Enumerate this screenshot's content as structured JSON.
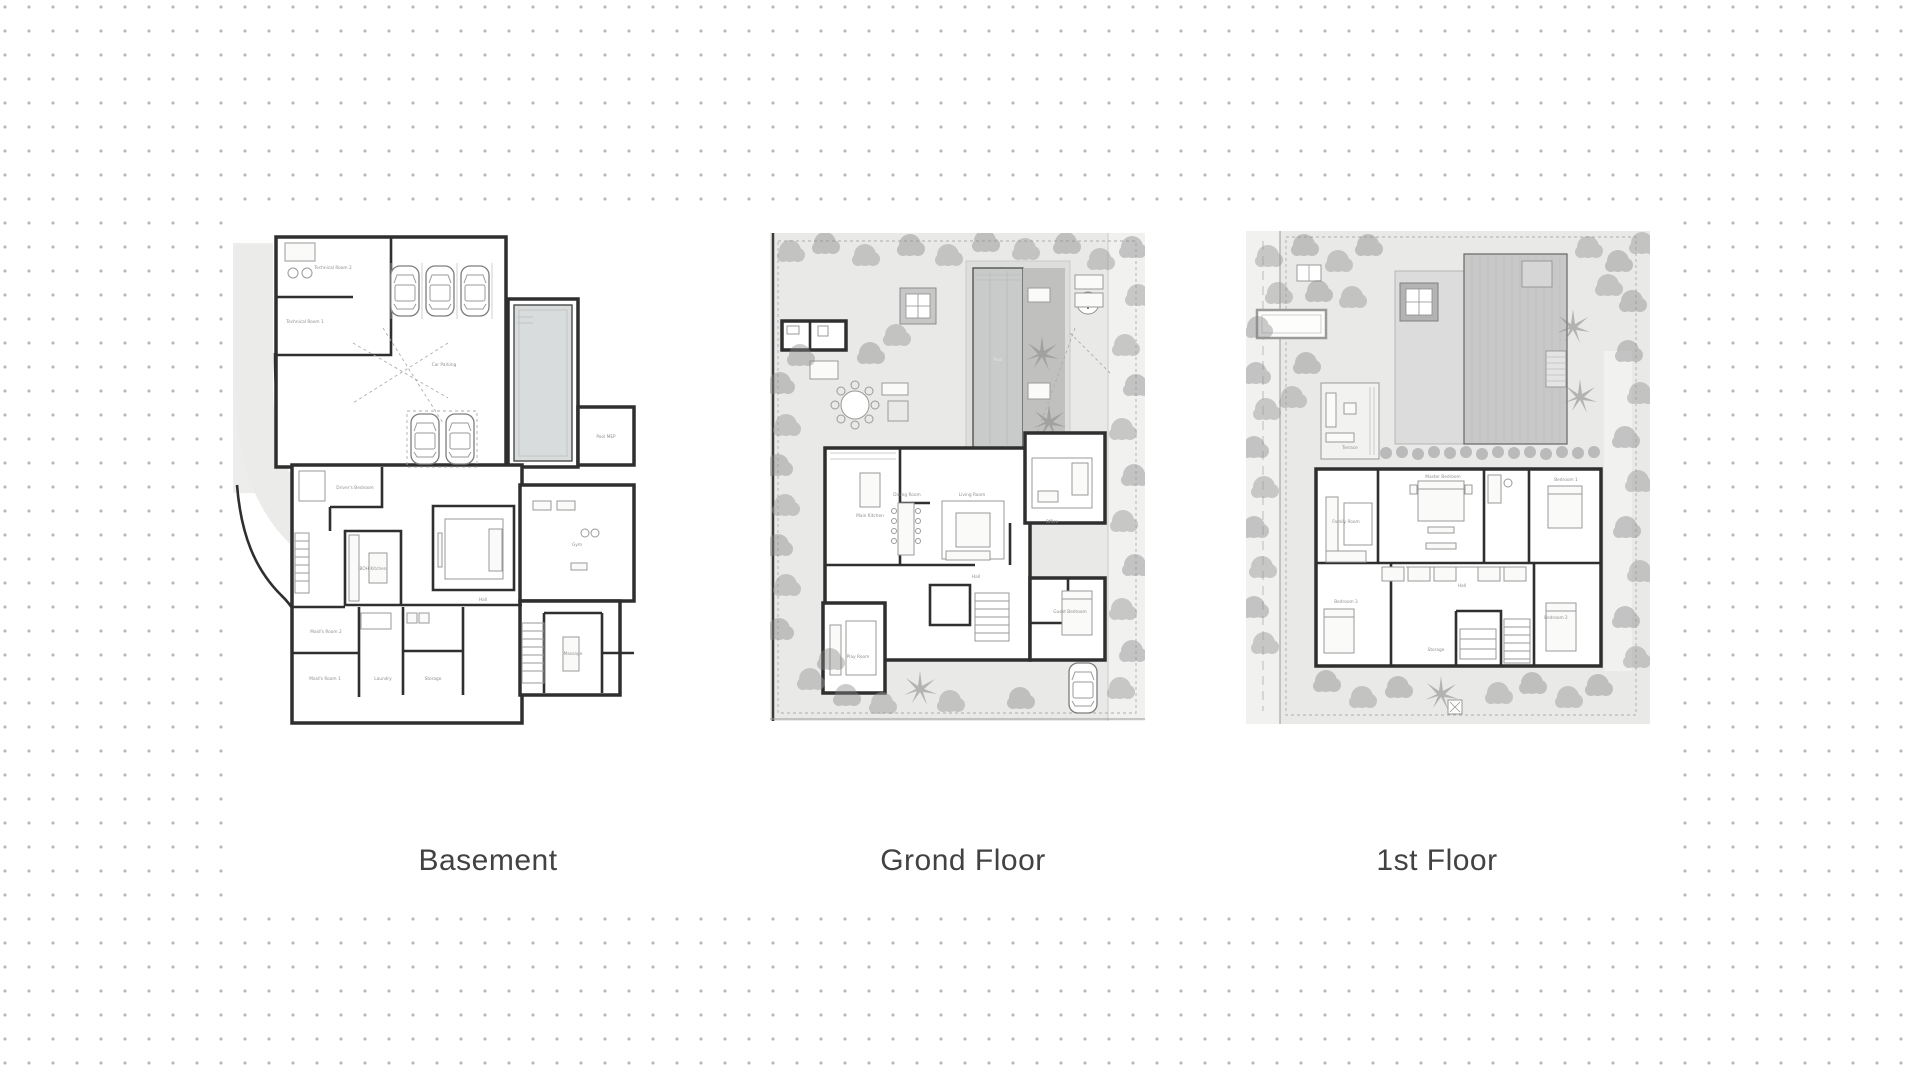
{
  "background": {
    "color": "#ffffff",
    "dot_color": "#b9b9b9"
  },
  "plans": [
    {
      "id": "basement",
      "caption": "Basement",
      "rooms": {
        "technical_room_2": "Technical Room 2",
        "technical_room_1": "Technical Room 1",
        "car_parking": "Car Parking",
        "pool_mep": "Pool MEP",
        "drivers_bedroom": "Driver's Bedroom",
        "boh_kitchen": "BOH Kitchen",
        "gym": "Gym",
        "hall": "Hall",
        "maids_room_2": "Maid's Room 2",
        "maids_room_1": "Maid's Room 1",
        "laundry": "Laundry",
        "storage": "Storage",
        "massage": "Massage"
      }
    },
    {
      "id": "ground-floor",
      "caption": "Grond Floor",
      "rooms": {
        "pool": "Pool",
        "main_kitchen": "Main Kitchen",
        "dining_room": "Dining Room",
        "living_room": "Living Room",
        "office": "Office",
        "hall": "Hall",
        "play_room": "Play Room",
        "guest_bedroom": "Guest Bedroom"
      }
    },
    {
      "id": "first-floor",
      "caption": "1st Floor",
      "rooms": {
        "terrace": "Terrace",
        "family_room": "Family Room",
        "master_bedroom": "Master Bedroom",
        "bedroom_1": "Bedroom 1",
        "hall": "Hall",
        "bedroom_3": "Bedroom 3",
        "storage": "Storage",
        "bedroom_2": "Bedroom 2"
      }
    }
  ]
}
